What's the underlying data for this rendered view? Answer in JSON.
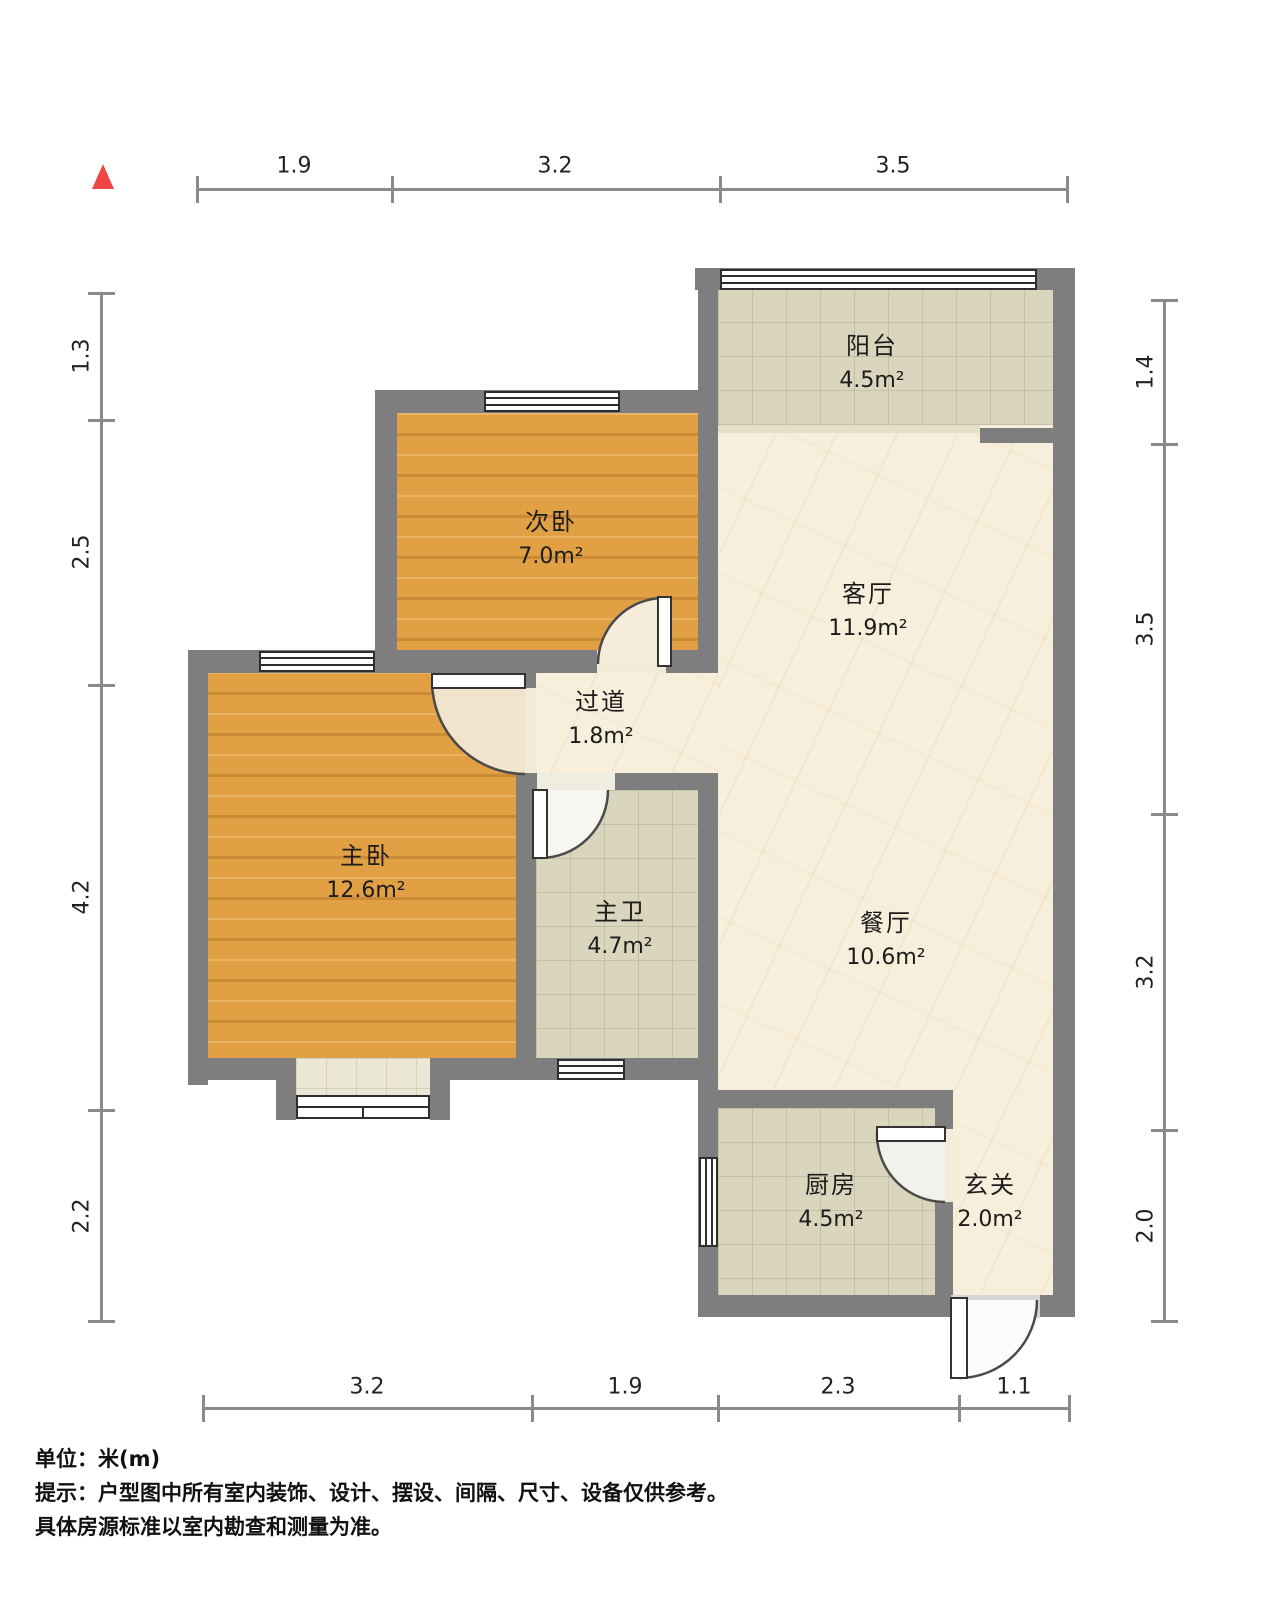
{
  "north_indicator": {
    "icon": "north-triangle",
    "color": "#ee4545"
  },
  "rooms": [
    {
      "key": "balcony",
      "name": "阳台",
      "area": "4.5m²"
    },
    {
      "key": "second-bedroom",
      "name": "次卧",
      "area": "7.0m²"
    },
    {
      "key": "living-room",
      "name": "客厅",
      "area": "11.9m²"
    },
    {
      "key": "hallway",
      "name": "过道",
      "area": "1.8m²"
    },
    {
      "key": "master-bedroom",
      "name": "主卧",
      "area": "12.6m²"
    },
    {
      "key": "master-bathroom",
      "name": "主卫",
      "area": "4.7m²"
    },
    {
      "key": "dining-room",
      "name": "餐厅",
      "area": "10.6m²"
    },
    {
      "key": "kitchen",
      "name": "厨房",
      "area": "4.5m²"
    },
    {
      "key": "entryway",
      "name": "玄关",
      "area": "2.0m²"
    }
  ],
  "dimensions": {
    "unit": "m",
    "top": [
      "1.9",
      "3.2",
      "3.5"
    ],
    "left": [
      "1.3",
      "2.5",
      "4.2",
      "2.2"
    ],
    "right": [
      "1.4",
      "3.5",
      "3.2",
      "2.0"
    ],
    "bottom": [
      "3.2",
      "1.9",
      "2.3",
      "1.1"
    ]
  },
  "footer": {
    "unit": "单位：米(m)",
    "note1": "提示：户型图中所有室内装饰、设计、摆设、间隔、尺寸、设备仅供参考。",
    "note2": "具体房源标准以室内勘查和测量为准。"
  },
  "colors": {
    "wall": "#7e7e7e",
    "wood_floor": "#e2a045",
    "tile_floor": "#d9d6bd",
    "marble_floor": "#f7efdc",
    "bay_floor": "#ebe7d5",
    "north_marker": "#ee4545",
    "dim_line": "#8a8a8a",
    "label_text": "#1c1c1c"
  }
}
